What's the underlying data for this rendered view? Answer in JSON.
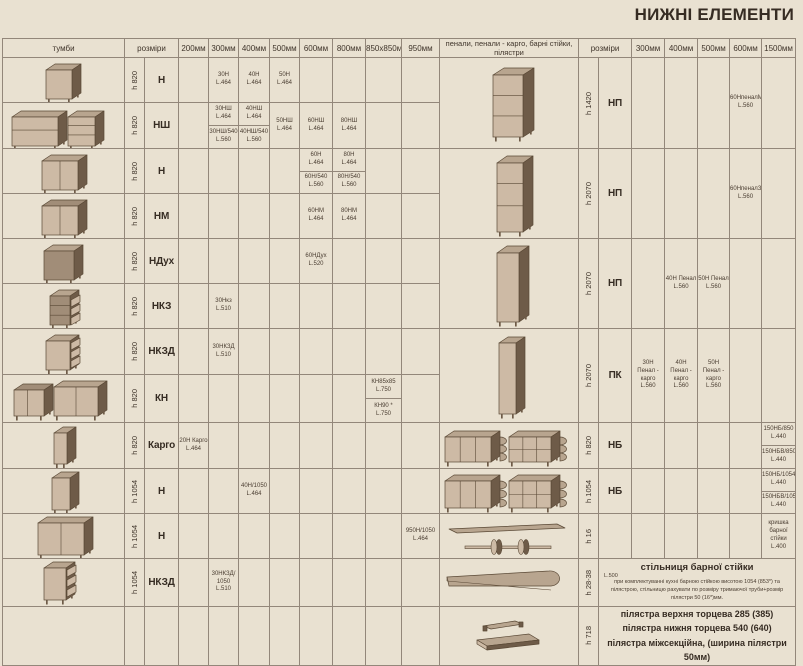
{
  "title": "НИЖНІ ЕЛЕМЕНТИ",
  "headers": {
    "tumby": "тумби",
    "rozmiry": "розміри",
    "left_cols": [
      "200мм",
      "300мм",
      "400мм",
      "500мм",
      "600мм",
      "800мм",
      "850х850мм",
      "950мм"
    ],
    "penaly": "пенали, пенали - карго, барні стійки, пілястри",
    "rozmiry2": "розміри",
    "right_cols": [
      "300мм",
      "400мм",
      "500мм",
      "600мм",
      "1500мм"
    ]
  },
  "rows_left": [
    {
      "h": "h 820",
      "type": "Н",
      "drawing": "base-door1",
      "cells": {
        "300мм": [
          [
            "30Н",
            "L.464"
          ]
        ],
        "400мм": [
          [
            "40Н",
            "L.464"
          ]
        ],
        "500мм": [
          [
            "50Н",
            "L.464"
          ]
        ]
      }
    },
    {
      "h": "h 820",
      "type": "НШ",
      "drawing": "pair-drawers",
      "cells": {
        "300мм": [
          [
            "30НШ",
            "L.464"
          ],
          [
            "30НШ/540",
            "L.560"
          ]
        ],
        "400мм": [
          [
            "40НШ",
            "L.464"
          ],
          [
            "40НШ/540",
            "L.560"
          ]
        ],
        "500мм": [
          [
            "50НШ",
            "L.464"
          ]
        ],
        "600мм": [
          [
            "60НШ",
            "L.464"
          ]
        ],
        "800мм": [
          [
            "80НШ",
            "L.464"
          ]
        ]
      }
    },
    {
      "h": "h 820",
      "type": "Н",
      "drawing": "base-door2",
      "cells": {
        "600мм": [
          [
            "60Н",
            "L.464"
          ],
          [
            "60Н/540",
            "L.560"
          ]
        ],
        "800мм": [
          [
            "80Н",
            "L.464"
          ],
          [
            "80Н/540",
            "L.560"
          ]
        ]
      }
    },
    {
      "h": "h 820",
      "type": "НМ",
      "drawing": "sink-door2",
      "cells": {
        "600мм": [
          [
            "60НМ",
            "L.464"
          ]
        ],
        "800мм": [
          [
            "80НМ",
            "L.464"
          ]
        ]
      }
    },
    {
      "h": "h 820",
      "type": "НДух",
      "drawing": "oven-open",
      "cells": {
        "600мм": [
          [
            "60НДух",
            "L.520"
          ]
        ]
      }
    },
    {
      "h": "h 820",
      "type": "НКЗ",
      "drawing": "cargo-shelves",
      "cells": {
        "300мм": [
          [
            "30Нкз",
            "L.510"
          ]
        ]
      }
    },
    {
      "h": "h 820",
      "type": "НКЗД",
      "drawing": "door-baskets",
      "cells": {
        "300мм": [
          [
            "30НКЗД",
            "L.510"
          ]
        ]
      }
    },
    {
      "h": "h 820",
      "type": "КН",
      "drawing": "corner-pair",
      "cells": {
        "850х850мм": [
          [
            "КН85х85",
            "L.750"
          ],
          [
            "КН90 *",
            "L.750"
          ]
        ]
      }
    },
    {
      "h": "h 820",
      "type": "Карго",
      "drawing": "cargo-narrow",
      "cells": {
        "200мм": [
          [
            "20Н Карго",
            "L.464"
          ]
        ]
      }
    },
    {
      "h": "h 1054",
      "type": "Н",
      "drawing": "tall-door1",
      "cells": {
        "400мм": [
          [
            "40Н/1050",
            "L.464"
          ]
        ]
      }
    },
    {
      "h": "h 1054",
      "type": "Н",
      "drawing": "tall-door2",
      "cells": {
        "950мм": [
          [
            "950Н/1050",
            "L.464"
          ]
        ]
      }
    },
    {
      "h": "h 1054",
      "type": "НКЗД",
      "drawing": "tall-baskets",
      "cells": {
        "300мм": [
          [
            "30НКЗД/",
            "1050",
            "L.510"
          ]
        ]
      }
    },
    {
      "h": "",
      "type": "",
      "drawing": "",
      "cells": {}
    }
  ],
  "rows_right": [
    {
      "rows": 2,
      "h": "h 1420",
      "type": "НП",
      "drawing": "penal-m",
      "cells": {
        "600мм": [
          [
            "60НпеналМ",
            "L.560"
          ]
        ]
      }
    },
    {
      "rows": 2,
      "h": "h 2070",
      "type": "НП",
      "drawing": "penal-3",
      "cells": {
        "600мм": [
          [
            "60НпеналЗ",
            "L.560"
          ]
        ]
      }
    },
    {
      "rows": 2,
      "h": "h 2070",
      "type": "НП",
      "drawing": "penal-door",
      "cells": {
        "400мм": [
          [
            "40Н Пенал",
            "L.560"
          ]
        ],
        "500мм": [
          [
            "50Н Пенал",
            "L.560"
          ]
        ]
      }
    },
    {
      "rows": 2,
      "h": "h 2070",
      "type": "ПК",
      "drawing": "penal-cargo",
      "cells": {
        "300мм": [
          [
            "30Н",
            "Пенал - карго",
            "L.560"
          ]
        ],
        "400мм": [
          [
            "40Н",
            "Пенал - карго",
            "L.560"
          ]
        ],
        "500мм": [
          [
            "50Н",
            "Пенал - карго",
            "L.560"
          ]
        ]
      }
    },
    {
      "rows": 1,
      "h": "h 820",
      "type": "НБ",
      "drawing": "bar-820",
      "cells": {
        "1500мм": [
          [
            "150НБ/850",
            "L.440"
          ],
          [
            "150НБВ/850",
            "L.440"
          ]
        ]
      }
    },
    {
      "rows": 1,
      "h": "h 1054",
      "type": "НБ",
      "drawing": "bar-1054",
      "cells": {
        "1500мм": [
          [
            "150НБ/1054",
            "L.440"
          ],
          [
            "150НБВ/1054",
            "L.440"
          ]
        ]
      }
    },
    {
      "rows": 1,
      "h": "h 16",
      "type": "",
      "drawing": "board-pipes",
      "cells": {
        "1500мм": [
          [
            "кришка барної",
            "стійки",
            "L.400"
          ]
        ]
      }
    },
    {
      "rows": 1,
      "h": "h 28-38",
      "type": "",
      "drawing": "bar-top",
      "merged": {
        "title": "стільниця барної стійки",
        "l": "L.500",
        "note": "при комплектуванні кухні барною стійкою висотою 1054 (853*) та пілястрою, стільницю рахувати по розміру тримаючої труби+розмір пілястри 50 (16*)мм."
      }
    },
    {
      "rows": 1,
      "h": "h 718",
      "type": "",
      "drawing": "pilasters",
      "merged_lines": [
        "пілястра верхня торцева 285 (385)",
        "пілястра нижня торцева 540 (640)",
        "пілястра міжсекційна, (ширина пілястри 50мм)"
      ]
    }
  ]
}
